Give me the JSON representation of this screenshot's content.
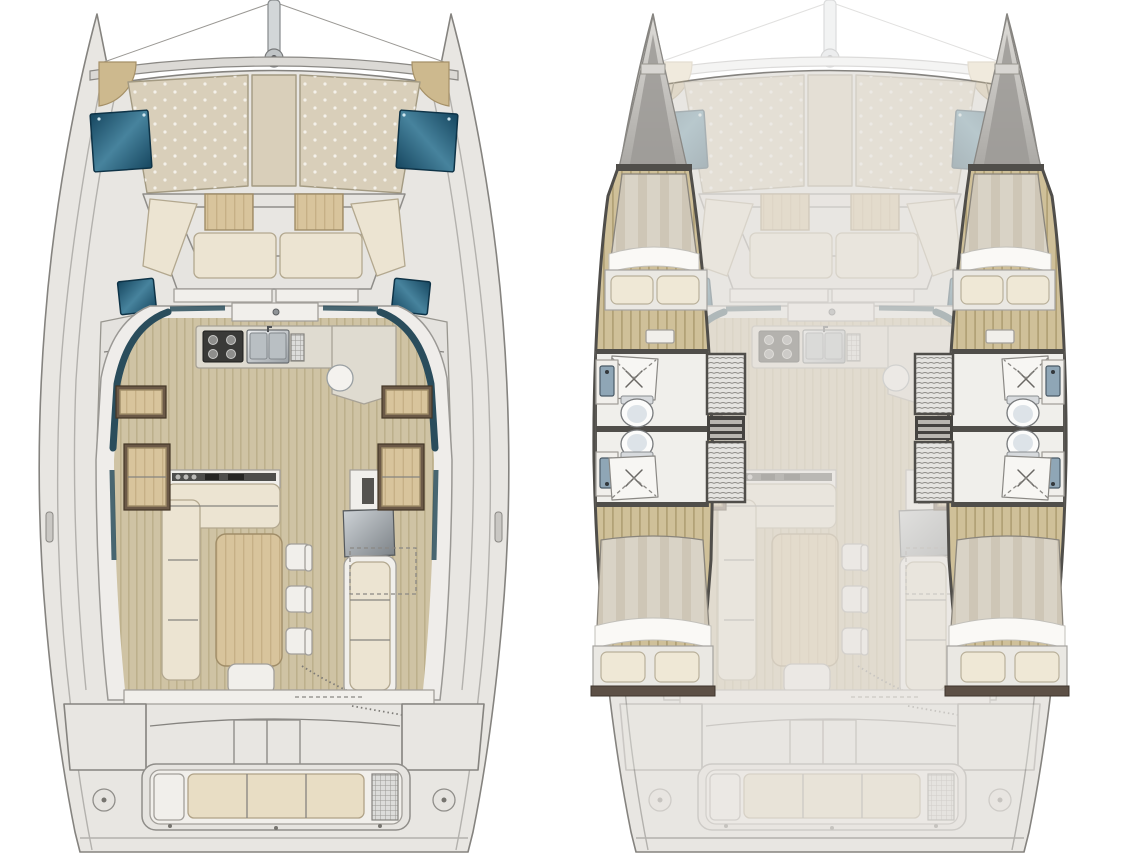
{
  "document": {
    "type": "catamaran-floorplan-diagram",
    "background": "#ffffff"
  },
  "views": {
    "left": {
      "name": "deck-and-saloon-plan"
    },
    "right": {
      "name": "hull-accommodation-plan"
    }
  },
  "features": {
    "deck_plan": [
      "mast",
      "rigging-lines",
      "crossbeam",
      "bow-sunpads",
      "deck-hatches",
      "forward-cockpit-seating",
      "forward-cockpit-tables",
      "saloon-window-band",
      "galley-stove",
      "galley-double-sink",
      "galley-round-sink",
      "l-shaped-sofa",
      "dining-table",
      "dining-chairs",
      "chaise-seat",
      "tv-screen",
      "wall-lockers",
      "aft-sliding-door",
      "cockpit-table",
      "transom-bench",
      "swim-deck-fittings"
    ],
    "accommodation_plan": {
      "port_hull": [
        "bow-locker",
        "forward-berth",
        "pillows",
        "hull-floor",
        "shower-forward",
        "toilet-forward",
        "washbasin-forward",
        "shower-aft",
        "toilet-aft",
        "washbasin-aft",
        "hanging-lockers",
        "companionway-steps",
        "aft-berth"
      ],
      "starboard_hull": [
        "bow-locker",
        "forward-berth",
        "pillows",
        "hull-floor",
        "shower-forward",
        "toilet-forward",
        "washbasin-forward",
        "shower-aft",
        "toilet-aft",
        "washbasin-aft",
        "hanging-lockers",
        "companionway-steps",
        "aft-berth"
      ]
    }
  },
  "colors": {
    "deck": "#e8e6e2",
    "deckR": "#f2f1ee",
    "hullStroke": "#85837f",
    "lineSoft": "#b3b1ad",
    "sunpad": "#d9cfba",
    "sunpadEdge": "#a39a82",
    "bolster": "#cdb98e",
    "cushion": "#ece4d2",
    "cushionEdge": "#b3a88f",
    "cushionAft": "#e8ddc4",
    "tealDark": "#16465f",
    "tealLight": "#47839d",
    "windowTeal": "#2a4d5c",
    "counter": "#dfdbd0",
    "counterEdge": "#a8a296",
    "stove": "#3a3a38",
    "woodLight": "#d8c49c",
    "woodDark": "#bfa97e",
    "floorLight": "#cfc3a4",
    "floorDark": "#bdb08c",
    "hullFloorLight": "#cfc099",
    "hullFloorDark": "#b2a277",
    "duvetLight": "#d9d3c6",
    "duvetDark": "#c6beac",
    "pillow": "#efe8d6",
    "fixtureBlue": "#8fa6b6",
    "wallDark": "#504e4a",
    "bedShelf": "#5d5046"
  },
  "render": {
    "ghost": "0.3"
  }
}
